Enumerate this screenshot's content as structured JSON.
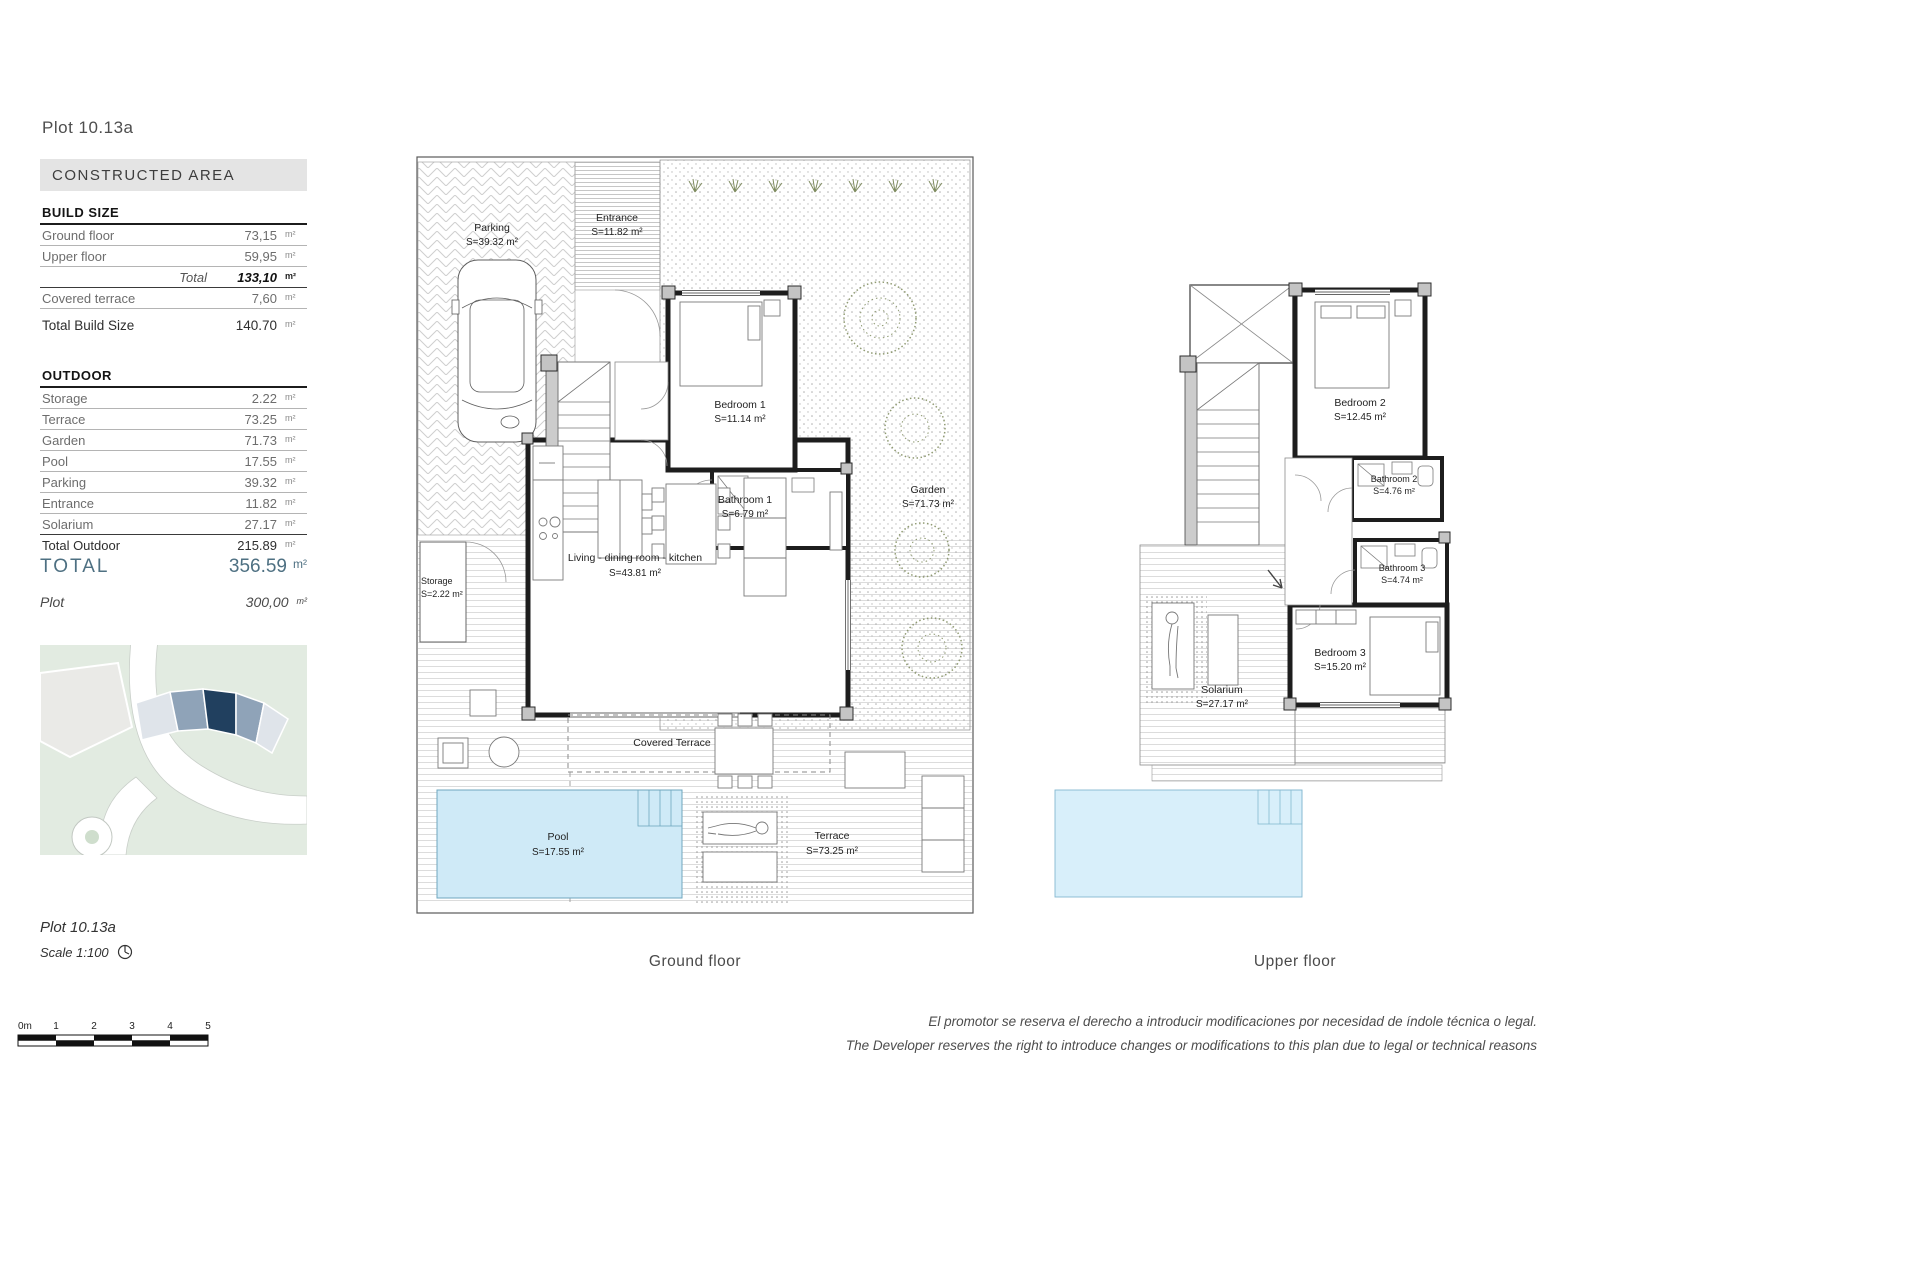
{
  "header": {
    "plot_title": "Plot 10.13a"
  },
  "constructed_area": {
    "header": "CONSTRUCTED AREA",
    "build_size": {
      "title": "BUILD SIZE",
      "rows": [
        {
          "label": "Ground floor",
          "value": "73,15",
          "unit": "m²"
        },
        {
          "label": "Upper floor",
          "value": "59,95",
          "unit": "m²"
        }
      ],
      "total_label": "Total",
      "total_value": "133,10",
      "total_unit": "m²",
      "covered_terrace": {
        "label": "Covered terrace",
        "value": "7,60",
        "unit": "m²"
      },
      "total_build": {
        "label": "Total Build Size",
        "value": "140.70",
        "unit": "m²"
      }
    },
    "outdoor": {
      "title": "OUTDOOR",
      "rows": [
        {
          "label": "Storage",
          "value": "2.22",
          "unit": "m²"
        },
        {
          "label": "Terrace",
          "value": "73.25",
          "unit": "m²"
        },
        {
          "label": "Garden",
          "value": "71.73",
          "unit": "m²"
        },
        {
          "label": "Pool",
          "value": "17.55",
          "unit": "m²"
        },
        {
          "label": "Parking",
          "value": "39.32",
          "unit": "m²"
        },
        {
          "label": "Entrance",
          "value": "11.82",
          "unit": "m²"
        },
        {
          "label": "Solarium",
          "value": "27.17",
          "unit": "m²"
        }
      ],
      "total": {
        "label": "Total Outdoor",
        "value": "215.89",
        "unit": "m²"
      }
    },
    "grand_total": {
      "label": "TOTAL",
      "value": "356.59",
      "unit": "m²"
    },
    "plot_row": {
      "label": "Plot",
      "value": "300,00",
      "unit": "m²"
    }
  },
  "ground_floor": {
    "caption": "Ground floor",
    "rooms": {
      "parking": {
        "name": "Parking",
        "area": "S=39.32 m²"
      },
      "entrance": {
        "name": "Entrance",
        "area": "S=11.82 m²"
      },
      "bedroom1": {
        "name": "Bedroom 1",
        "area": "S=11.14 m²"
      },
      "bathroom1": {
        "name": "Bathroom 1",
        "area": "S=6.79 m²"
      },
      "living": {
        "name": "Living - dining  room - kitchen",
        "area": "S=43.81 m²"
      },
      "garden": {
        "name": "Garden",
        "area": "S=71.73 m²"
      },
      "storage": {
        "name": "Storage",
        "area": "S=2.22 m²"
      },
      "covered_terrace": {
        "name": "Covered Terrace"
      },
      "pool": {
        "name": "Pool",
        "area": "S=17.55 m²"
      },
      "terrace": {
        "name": "Terrace",
        "area": "S=73.25 m²"
      }
    }
  },
  "upper_floor": {
    "caption": "Upper floor",
    "rooms": {
      "bedroom2": {
        "name": "Bedroom 2",
        "area": "S=12.45 m²"
      },
      "bathroom2": {
        "name": "Bathroom 2",
        "area": "S=4.76 m²"
      },
      "bathroom3": {
        "name": "Bathroom 3",
        "area": "S=4.74 m²"
      },
      "bedroom3": {
        "name": "Bedroom 3",
        "area": "S=15.20 m²"
      },
      "solarium": {
        "name": "Solarium",
        "area": "S=27.17 m²"
      }
    }
  },
  "footer": {
    "plot_label": "Plot 10.13a",
    "scale_label": "Scale 1:100",
    "scale_bar": {
      "zero": "0m",
      "ticks": [
        "1",
        "2",
        "3",
        "4",
        "5"
      ]
    },
    "disclaimer_es": "El promotor se reserva el derecho a introducir modificaciones por necesidad de índole técnica o legal.",
    "disclaimer_en": "The Developer reserves the right to introduce changes or modifications to this plan due to legal or technical reasons"
  },
  "colors": {
    "accent_total": "#4e7082",
    "pool": "#cfeaf7",
    "plot_highlight": "#21405f",
    "site_green": "#e2ebe1"
  }
}
